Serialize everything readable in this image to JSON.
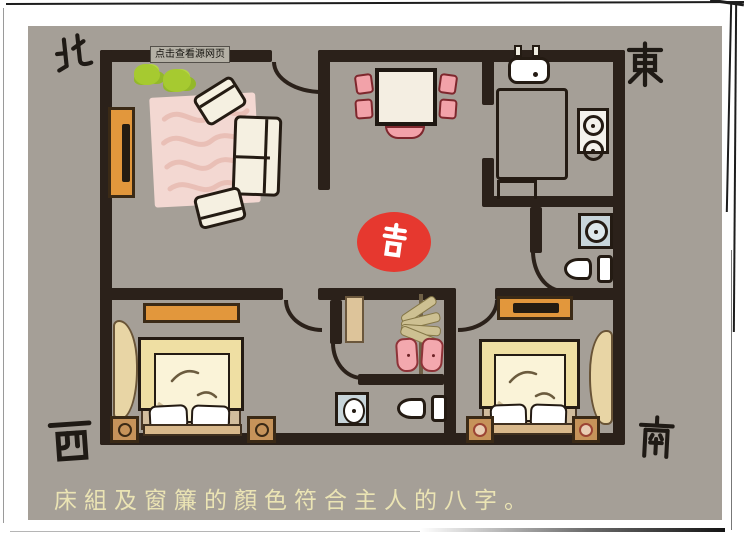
{
  "window": {
    "tooltip_link": "点击查看源网页"
  },
  "caption": {
    "text": "床組及窗簾的顏色符合主人的八字。"
  },
  "compass": {
    "north": "北",
    "east": "東",
    "west": "西",
    "south": "南"
  },
  "badge": {
    "label": "吉"
  },
  "colors": {
    "floor": "#a59f97",
    "wall": "#2b211a",
    "badge_red": "#e6382f",
    "caption_text": "#ebe4b4",
    "wood_orange": "#e2973c",
    "bed_yellow": "#efdfa3",
    "chair_pink": "#f2a2a9",
    "plant_green": "#a6ca30",
    "fixture_blue": "#c8d5da",
    "rug_pink": "#f3d8d2",
    "headboard_tan": "#d8b88b"
  },
  "rooms": {
    "living_room": {
      "items": [
        "plant",
        "plant",
        "tv-cabinet",
        "rug",
        "sofa",
        "armchair",
        "armchair"
      ]
    },
    "dining_room": {
      "items": [
        "dining-table",
        "chair",
        "chair",
        "chair",
        "chair",
        "chair"
      ]
    },
    "kitchen": {
      "items": [
        "sink",
        "counter",
        "stove",
        "small-table"
      ]
    },
    "bathroom_east": {
      "items": [
        "washing-machine",
        "toilet"
      ]
    },
    "closet_room": {
      "items": [
        "door-panel",
        "clothes-rack"
      ]
    },
    "bathroom_center": {
      "items": [
        "wash-basin",
        "toilet"
      ]
    },
    "bedroom_west": {
      "items": [
        "dresser",
        "double-bed",
        "pillow",
        "pillow",
        "nightstand",
        "nightstand",
        "curtain"
      ]
    },
    "bedroom_south": {
      "items": [
        "tv-dresser",
        "double-bed",
        "pillow",
        "pillow",
        "nightstand",
        "nightstand",
        "curtain"
      ]
    }
  }
}
